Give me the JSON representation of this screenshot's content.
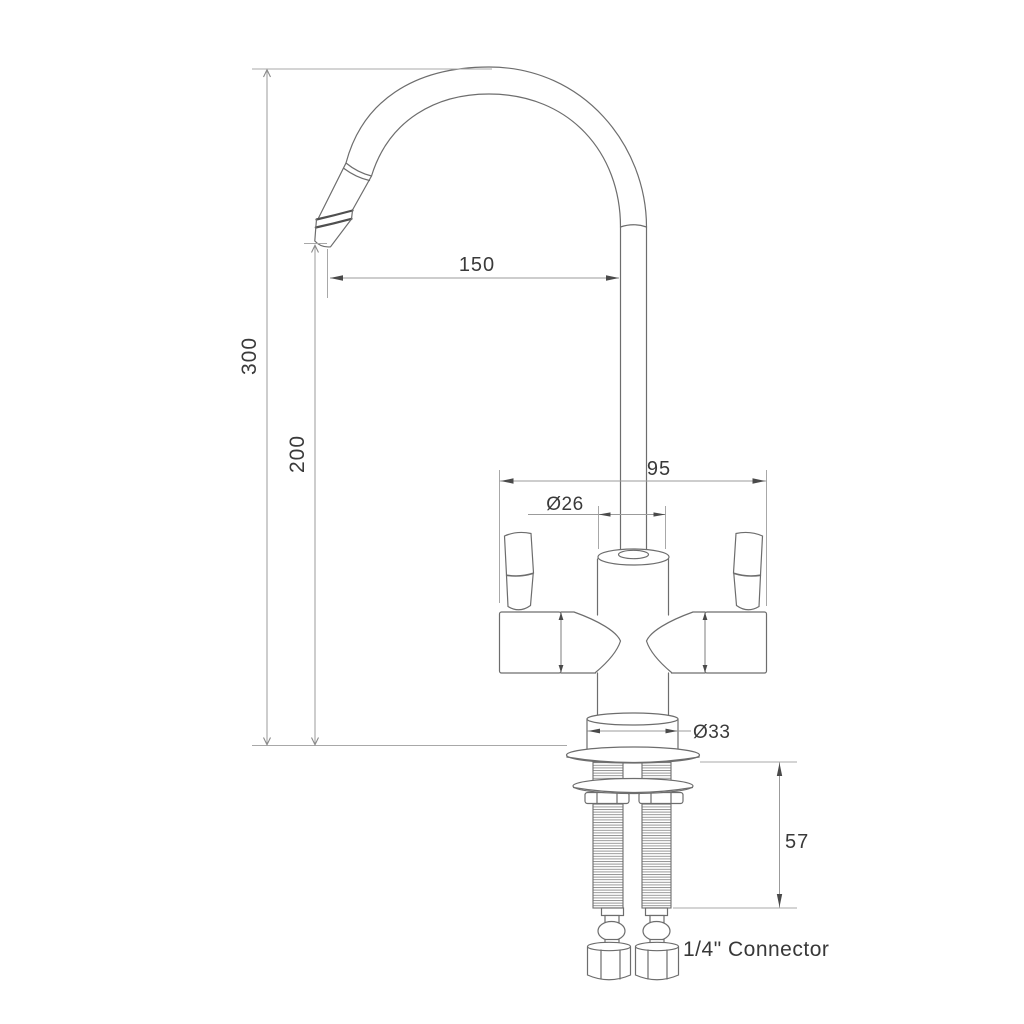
{
  "drawing": {
    "dimensions": {
      "overall_height": "300",
      "tip_height": "200",
      "spout_reach": "150",
      "body_width": "95",
      "column_diameter": "Ø26",
      "base_diameter": "Ø33",
      "shank_length": "57"
    },
    "labels": {
      "connector": "1/4\" Connector"
    },
    "colors": {
      "background": "#ffffff",
      "object_line": "#6d6d6d",
      "dimension_line": "#9b9b9b",
      "text": "#3a3a3a"
    }
  }
}
